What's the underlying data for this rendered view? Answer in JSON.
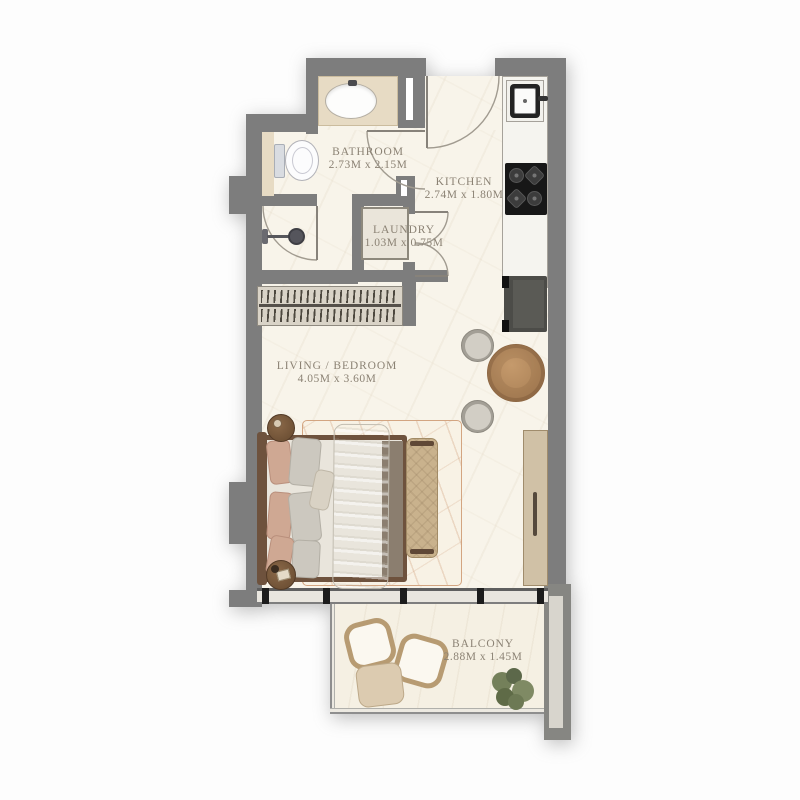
{
  "plan_type": "apartment-floor-plan",
  "rooms": {
    "bathroom": {
      "name": "BATHROOM",
      "dims": "2.73M x 2.15M"
    },
    "kitchen": {
      "name": "KITCHEN",
      "dims": "2.74M x 1.80M"
    },
    "laundry": {
      "name": "LAUNDRY",
      "dims": "1.03M x 0.75M"
    },
    "living_bedroom": {
      "name": "LIVING / BEDROOM",
      "dims": "4.05M x 3.60M"
    },
    "balcony": {
      "name": "BALCONY",
      "dims": "2.88M x 1.45M"
    }
  },
  "fixtures": {
    "bathroom": [
      "vanity-sink",
      "toilet",
      "shower-head",
      "shower-door"
    ],
    "laundry": [
      "washing-machine",
      "double-doors"
    ],
    "kitchen": [
      "kitchen-sink",
      "stove-4-burner",
      "counter",
      "fridge"
    ],
    "living_bedroom": [
      "wardrobe-hanger-rack",
      "double-bed",
      "pillows",
      "throw-blanket",
      "bench",
      "side-table",
      "side-table",
      "rug",
      "dining-table",
      "dining-chair",
      "dining-chair",
      "tv-console",
      "sliding-window"
    ],
    "balcony": [
      "outdoor-chair",
      "outdoor-chair",
      "outdoor-table",
      "plant"
    ]
  },
  "colors": {
    "wall": "#7d7d7d",
    "floor": "#f8f4ea",
    "vanity_beige": "#e7dbc4",
    "wood": "#b18256",
    "bench": "#c9b28d",
    "label_text": "#8b8274"
  }
}
